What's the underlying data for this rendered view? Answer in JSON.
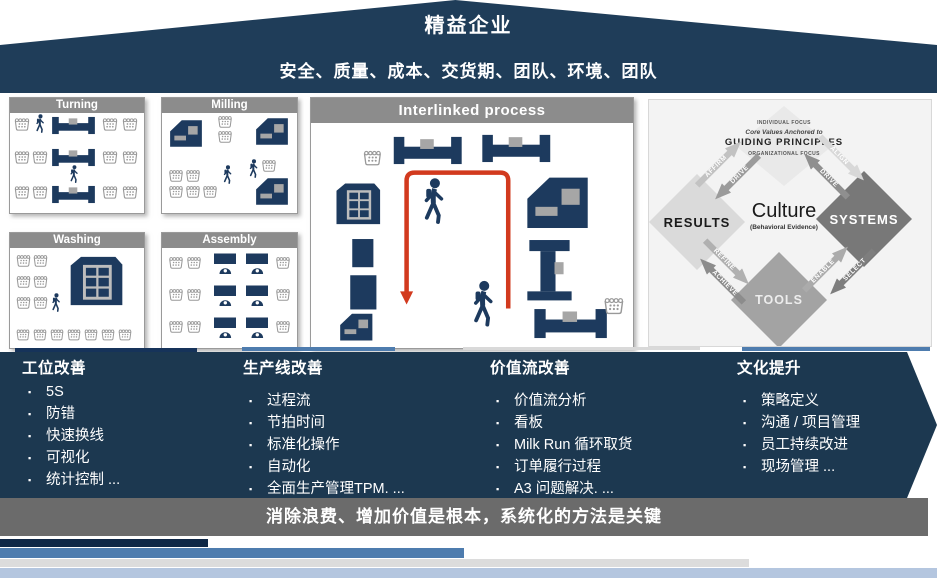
{
  "banner": {
    "title": "精益企业",
    "subtitle": "安全、质量、成本、交货期、团队、环境、团队"
  },
  "panels": {
    "turning": {
      "title": "Turning"
    },
    "milling": {
      "title": "Milling"
    },
    "washing": {
      "title": "Washing"
    },
    "assembly": {
      "title": "Assembly"
    },
    "interlinked": {
      "title": "Interlinked process"
    }
  },
  "culture": {
    "individual_focus": "INDIVIDUAL FOCUS",
    "core_values": "Core Values Anchored to",
    "guiding_principles": "GUIDING  PRINCIPLES",
    "organizational_focus": "ORGANIZATIONAL FOCUS",
    "results": "RESULTS",
    "systems": "SYSTEMS",
    "tools": "TOOLS",
    "center_title": "Culture",
    "center_sub": "(Behavioral Evidence)",
    "arrows": {
      "affirm": "AFFIRM",
      "drive_left": "DRIVE",
      "align": "ALIGN",
      "drive_right": "DRIVE",
      "enable": "ENABLE",
      "select": "SELECT",
      "refine": "REFINE",
      "achieve": "ACHIEVE"
    }
  },
  "columns": [
    {
      "title": "工位改善",
      "items": [
        "5S",
        "防错",
        "快速换线",
        "可视化",
        "统计控制 ..."
      ]
    },
    {
      "title": "生产线改善",
      "items": [
        "过程流",
        "节拍时间",
        "标准化操作",
        "自动化",
        "全面生产管理TPM. ..."
      ]
    },
    {
      "title": "价值流改善",
      "items": [
        "价值流分析",
        "看板",
        "Milk Run 循环取货",
        "订单履行过程",
        "A3 问题解决. ..."
      ]
    },
    {
      "title": "文化提升",
      "items": [
        "策略定义",
        "沟通 / 项目管理",
        "员工持续改进",
        "现场管理 ..."
      ]
    }
  ],
  "footer": {
    "message": "消除浪费、增加价值是根本，系统化的方法是关键"
  },
  "icons": {
    "person": "walking-worker-icon",
    "basket": "parts-basket-icon",
    "lathe": "lathe-machine-icon",
    "mill": "milling-machine-icon",
    "washer": "washing-machine-icon",
    "bench": "assembly-bench-icon",
    "route": "milk-run-route-arrow"
  },
  "colors": {
    "navy": "#1F3D59",
    "navy-band": "#1C3850",
    "steel": "#4E7CAE",
    "light-blue": "#B4C6DF",
    "light-gray": "#DCDCDC",
    "gray-band": "#6B6B6B",
    "panel-header": "#8C8C8C",
    "red-path": "#D23A1E",
    "machine-navy": "#1D3A5E"
  }
}
